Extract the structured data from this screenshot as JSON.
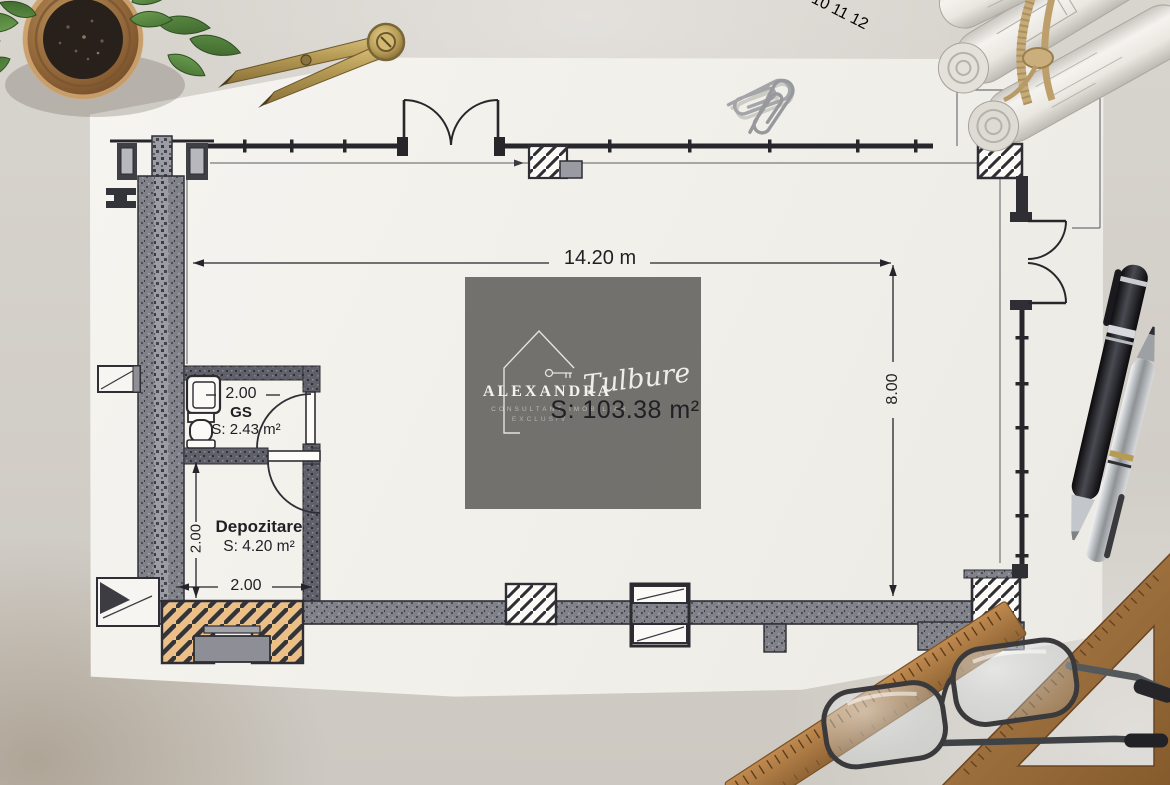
{
  "watermark": {
    "brand_top": "ALEXANDRA",
    "brand_script": "Tulbure",
    "tagline_line1": "CONSULTANT IMOBILIAR",
    "tagline_line2": "EXCLUSIV"
  },
  "plan": {
    "main_area": "S: 103.38 m²",
    "width_dim": "14.20 m",
    "height_dim": "8.00",
    "gs_dim": "2.00",
    "gs_name": "GS",
    "gs_area": "S: 2.43 m²",
    "dep_name": "Depozitare",
    "dep_area": "S: 4.20 m²",
    "dep_side_dim": "2.00",
    "dep_bottom_dim": "2.00"
  },
  "props": {
    "ruler_numbers": [
      "4",
      "5",
      "6",
      "7",
      "8",
      "9",
      "10",
      "11",
      "12"
    ]
  },
  "colors": {
    "ink": "#26262b",
    "paper": "#f3f1ec",
    "desk": "#d5d1cb",
    "watermark_bg": "#6f6e6b",
    "wood": "#a9793f",
    "entrance_tan": "#ecbf87",
    "brass": "#b59a54"
  }
}
